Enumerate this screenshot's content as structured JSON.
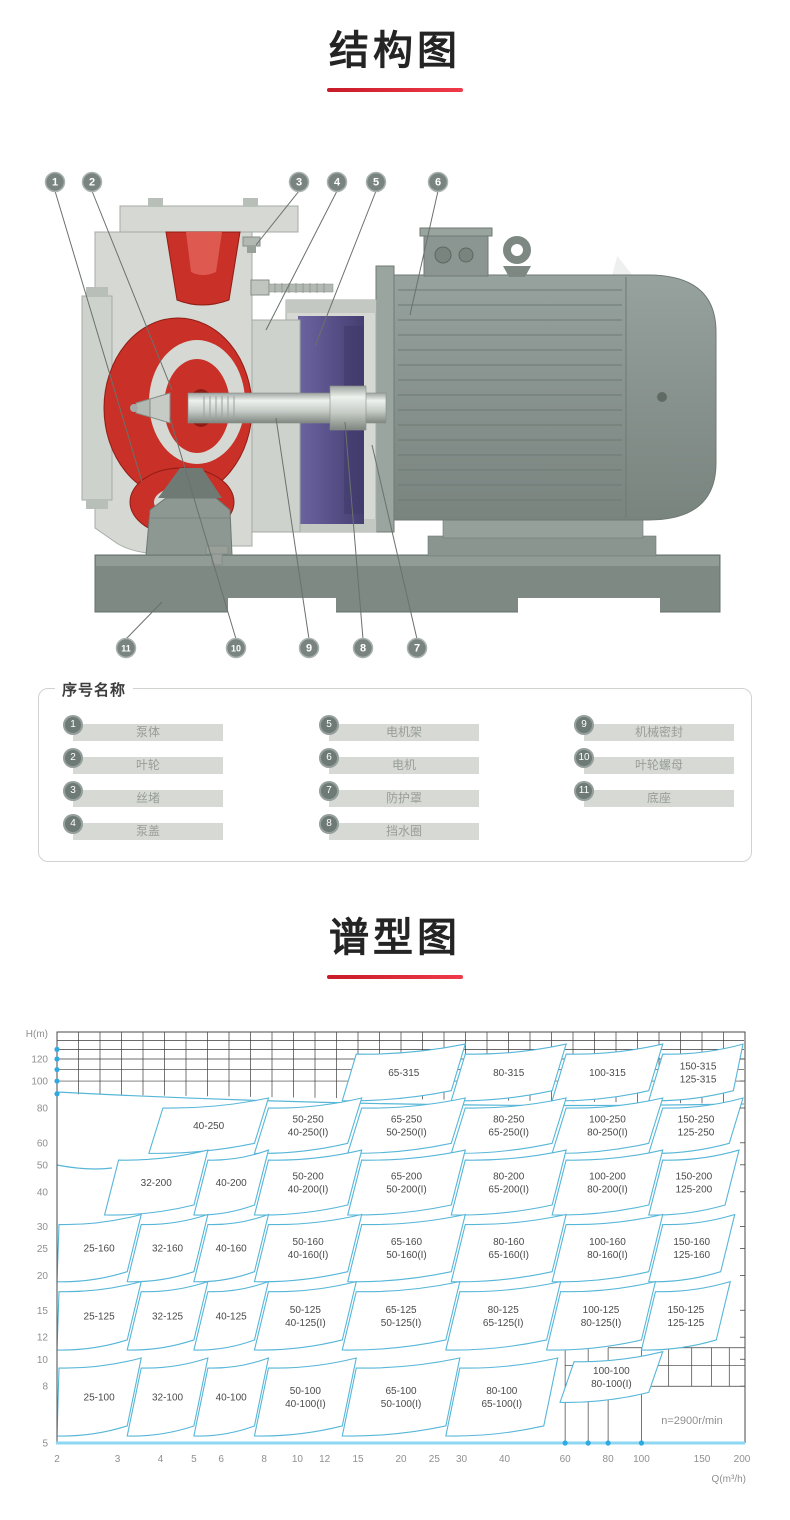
{
  "sections": {
    "structure": {
      "title": "结构图"
    },
    "spectrum": {
      "title": "谱型图"
    }
  },
  "colors": {
    "underline": "#e02633",
    "region_stroke": "#57b6d8",
    "grid": "#3c3c3c",
    "axis_cyan": "#8ed7f2",
    "dot_blue": "#2fa9e1",
    "tick_text": "#8f8f8f",
    "red_part": "#c93027",
    "purple_part": "#554d85",
    "gray_metal": "#8a9591"
  },
  "legend": {
    "title": "序号名称",
    "items": [
      {
        "num": "1",
        "label": "泵体"
      },
      {
        "num": "2",
        "label": "叶轮"
      },
      {
        "num": "3",
        "label": "丝堵"
      },
      {
        "num": "4",
        "label": "泵盖"
      },
      {
        "num": "5",
        "label": "电机架"
      },
      {
        "num": "6",
        "label": "电机"
      },
      {
        "num": "7",
        "label": "防护罩"
      },
      {
        "num": "8",
        "label": "挡水圈"
      },
      {
        "num": "9",
        "label": "机械密封"
      },
      {
        "num": "10",
        "label": "叶轮螺母"
      },
      {
        "num": "11",
        "label": "底座"
      }
    ]
  },
  "diagram": {
    "callouts": [
      {
        "n": "1",
        "cx": 55,
        "cy": 32,
        "tx": 142,
        "ty": 332
      },
      {
        "n": "2",
        "cx": 92,
        "cy": 32,
        "tx": 172,
        "ty": 240
      },
      {
        "n": "3",
        "cx": 299,
        "cy": 32,
        "tx": 256,
        "ty": 95
      },
      {
        "n": "4",
        "cx": 337,
        "cy": 32,
        "tx": 266,
        "ty": 180
      },
      {
        "n": "5",
        "cx": 376,
        "cy": 32,
        "tx": 315,
        "ty": 196
      },
      {
        "n": "6",
        "cx": 438,
        "cy": 32,
        "tx": 410,
        "ty": 165
      },
      {
        "n": "11",
        "cx": 126,
        "cy": 498,
        "tx": 162,
        "ty": 452
      },
      {
        "n": "10",
        "cx": 236,
        "cy": 498,
        "tx": 170,
        "ty": 268
      },
      {
        "n": "9",
        "cx": 309,
        "cy": 498,
        "tx": 276,
        "ty": 268
      },
      {
        "n": "8",
        "cx": 363,
        "cy": 498,
        "tx": 345,
        "ty": 272
      },
      {
        "n": "7",
        "cx": 417,
        "cy": 498,
        "tx": 372,
        "ty": 295
      }
    ]
  },
  "chart_data": {
    "type": "region-map",
    "title": "谱型图",
    "xlabel": "Q(m³/h)",
    "ylabel": "H(m)",
    "annotation": "n=2900r/min",
    "x_range": [
      2,
      200
    ],
    "y_range": [
      5,
      150
    ],
    "x_ticks": [
      2,
      3,
      4,
      5,
      6,
      8,
      10,
      12,
      15,
      20,
      25,
      30,
      40,
      60,
      80,
      100,
      150,
      200
    ],
    "y_ticks": [
      120,
      100,
      80,
      60,
      50,
      40,
      30,
      25,
      20,
      15,
      12,
      10,
      8,
      5
    ],
    "top_band_lines_h": [
      140,
      130,
      120,
      110,
      100
    ],
    "axis_dots_h": [
      130,
      120,
      110,
      100,
      90
    ],
    "axis_dots_q": [
      60,
      70,
      80,
      100
    ],
    "grid": true,
    "legend_position": "none",
    "regions": [
      {
        "l": [
          "65-315"
        ],
        "q": [
          13.5,
          28
        ],
        "h": [
          85,
          125
        ]
      },
      {
        "l": [
          "80-315"
        ],
        "q": [
          28,
          55
        ],
        "h": [
          85,
          125
        ]
      },
      {
        "l": [
          "100-315"
        ],
        "q": [
          55,
          105
        ],
        "h": [
          85,
          125
        ]
      },
      {
        "l": [
          "150-315",
          "125-315"
        ],
        "q": [
          105,
          185
        ],
        "h": [
          85,
          125
        ]
      },
      {
        "l": [
          "40-250"
        ],
        "q": [
          3.7,
          7.5
        ],
        "h": [
          55,
          80
        ]
      },
      {
        "l": [
          "50-250",
          "40-250(I)"
        ],
        "q": [
          7.5,
          14
        ],
        "h": [
          55,
          80
        ]
      },
      {
        "l": [
          "65-250",
          "50-250(I)"
        ],
        "q": [
          14,
          28
        ],
        "h": [
          55,
          80
        ]
      },
      {
        "l": [
          "80-250",
          "65-250(I)"
        ],
        "q": [
          28,
          55
        ],
        "h": [
          55,
          80
        ]
      },
      {
        "l": [
          "100-250",
          "80-250(I)"
        ],
        "q": [
          55,
          105
        ],
        "h": [
          55,
          80
        ]
      },
      {
        "l": [
          "150-250",
          "125-250"
        ],
        "q": [
          105,
          180
        ],
        "h": [
          55,
          80
        ]
      },
      {
        "l": [
          "32-200"
        ],
        "q": [
          2.75,
          5
        ],
        "h": [
          33,
          52
        ]
      },
      {
        "l": [
          "40-200"
        ],
        "q": [
          5,
          7.5
        ],
        "h": [
          33,
          52
        ]
      },
      {
        "l": [
          "50-200",
          "40-200(I)"
        ],
        "q": [
          7.5,
          14
        ],
        "h": [
          33,
          52
        ]
      },
      {
        "l": [
          "65-200",
          "50-200(I)"
        ],
        "q": [
          14,
          28
        ],
        "h": [
          33,
          52
        ]
      },
      {
        "l": [
          "80-200",
          "65-200(I)"
        ],
        "q": [
          28,
          55
        ],
        "h": [
          33,
          52
        ]
      },
      {
        "l": [
          "100-200",
          "80-200(I)"
        ],
        "q": [
          55,
          105
        ],
        "h": [
          33,
          52
        ]
      },
      {
        "l": [
          "150-200",
          "125-200"
        ],
        "q": [
          105,
          175
        ],
        "h": [
          33,
          52
        ]
      },
      {
        "l": [
          "25-160"
        ],
        "q": [
          2,
          3.2
        ],
        "h": [
          19,
          30.5
        ]
      },
      {
        "l": [
          "32-160"
        ],
        "q": [
          3.2,
          5
        ],
        "h": [
          19,
          30.5
        ]
      },
      {
        "l": [
          "40-160"
        ],
        "q": [
          5,
          7.5
        ],
        "h": [
          19,
          30.5
        ]
      },
      {
        "l": [
          "50-160",
          "40-160(I)"
        ],
        "q": [
          7.5,
          14
        ],
        "h": [
          19,
          30.5
        ]
      },
      {
        "l": [
          "65-160",
          "50-160(I)"
        ],
        "q": [
          14,
          28
        ],
        "h": [
          19,
          30.5
        ]
      },
      {
        "l": [
          "80-160",
          "65-160(I)"
        ],
        "q": [
          28,
          55
        ],
        "h": [
          19,
          30.5
        ]
      },
      {
        "l": [
          "100-160",
          "80-160(I)"
        ],
        "q": [
          55,
          105
        ],
        "h": [
          19,
          30.5
        ]
      },
      {
        "l": [
          "150-160",
          "125-160"
        ],
        "q": [
          105,
          170
        ],
        "h": [
          19,
          30.5
        ]
      },
      {
        "l": [
          "25-125"
        ],
        "q": [
          2,
          3.2
        ],
        "h": [
          10.8,
          17.5
        ]
      },
      {
        "l": [
          "32-125"
        ],
        "q": [
          3.2,
          5
        ],
        "h": [
          10.8,
          17.5
        ]
      },
      {
        "l": [
          "40-125"
        ],
        "q": [
          5,
          7.5
        ],
        "h": [
          10.8,
          17.5
        ]
      },
      {
        "l": [
          "50-125",
          "40-125(I)"
        ],
        "q": [
          7.5,
          13.5
        ],
        "h": [
          10.8,
          17.5
        ]
      },
      {
        "l": [
          "65-125",
          "50-125(I)"
        ],
        "q": [
          13.5,
          27
        ],
        "h": [
          10.8,
          17.5
        ]
      },
      {
        "l": [
          "80-125",
          "65-125(I)"
        ],
        "q": [
          27,
          53
        ],
        "h": [
          10.8,
          17.5
        ]
      },
      {
        "l": [
          "100-125",
          "80-125(I)"
        ],
        "q": [
          53,
          100
        ],
        "h": [
          10.8,
          17.5
        ]
      },
      {
        "l": [
          "150-125",
          "125-125"
        ],
        "q": [
          100,
          165
        ],
        "h": [
          10.8,
          17.5
        ]
      },
      {
        "l": [
          "25-100"
        ],
        "q": [
          2,
          3.2
        ],
        "h": [
          5.3,
          9.3
        ]
      },
      {
        "l": [
          "32-100"
        ],
        "q": [
          3.2,
          5
        ],
        "h": [
          5.3,
          9.3
        ]
      },
      {
        "l": [
          "40-100"
        ],
        "q": [
          5,
          7.5
        ],
        "h": [
          5.3,
          9.3
        ]
      },
      {
        "l": [
          "50-100",
          "40-100(I)"
        ],
        "q": [
          7.5,
          13.5
        ],
        "h": [
          5.3,
          9.3
        ]
      },
      {
        "l": [
          "65-100",
          "50-100(I)"
        ],
        "q": [
          13.5,
          27
        ],
        "h": [
          5.3,
          9.3
        ]
      },
      {
        "l": [
          "80-100",
          "65-100(I)"
        ],
        "q": [
          27,
          52
        ],
        "h": [
          5.3,
          9.3
        ]
      },
      {
        "l": [
          "100-100",
          "80-100(I)"
        ],
        "q": [
          58,
          105
        ],
        "h": [
          7,
          9.8
        ]
      }
    ]
  }
}
